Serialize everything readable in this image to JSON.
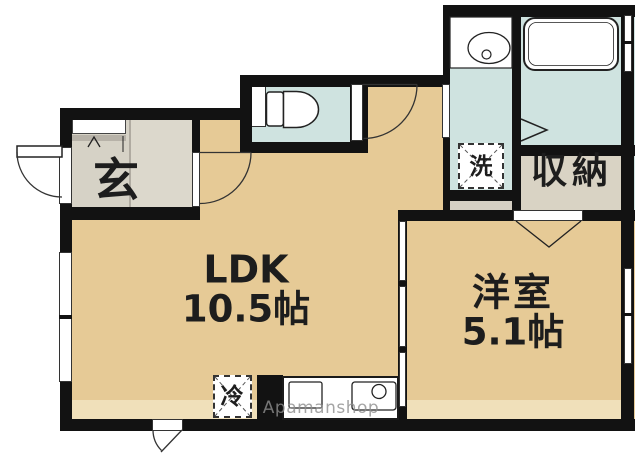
{
  "plan": {
    "type": "japanese-apartment-floor-plan",
    "rooms": {
      "ldk": {
        "name": "LDK",
        "size": "10.5帖"
      },
      "western_room": {
        "name": "洋室",
        "size": "5.1帖"
      },
      "entrance": {
        "label": "玄"
      },
      "storage": {
        "label": "収納"
      },
      "washer_spot": {
        "label": "洗"
      },
      "fridge_spot": {
        "label": "冷"
      }
    },
    "fixtures": [
      "toilet",
      "bathtub",
      "wash-basin",
      "kitchen-counter",
      "shoe-cabinet"
    ],
    "watermark": "Apamanshop",
    "colors": {
      "floor_tan": "#e6ca96",
      "floor_band": "#f0e0ba",
      "wet_area_blue": "#cfe3e0",
      "entrance_tile": "#d6d2c6",
      "entrance_hall": "#dcd8cc",
      "storage_grey": "#d9d3c4",
      "wall": "#121212",
      "watermark_grey": "#8e8e8e"
    }
  }
}
